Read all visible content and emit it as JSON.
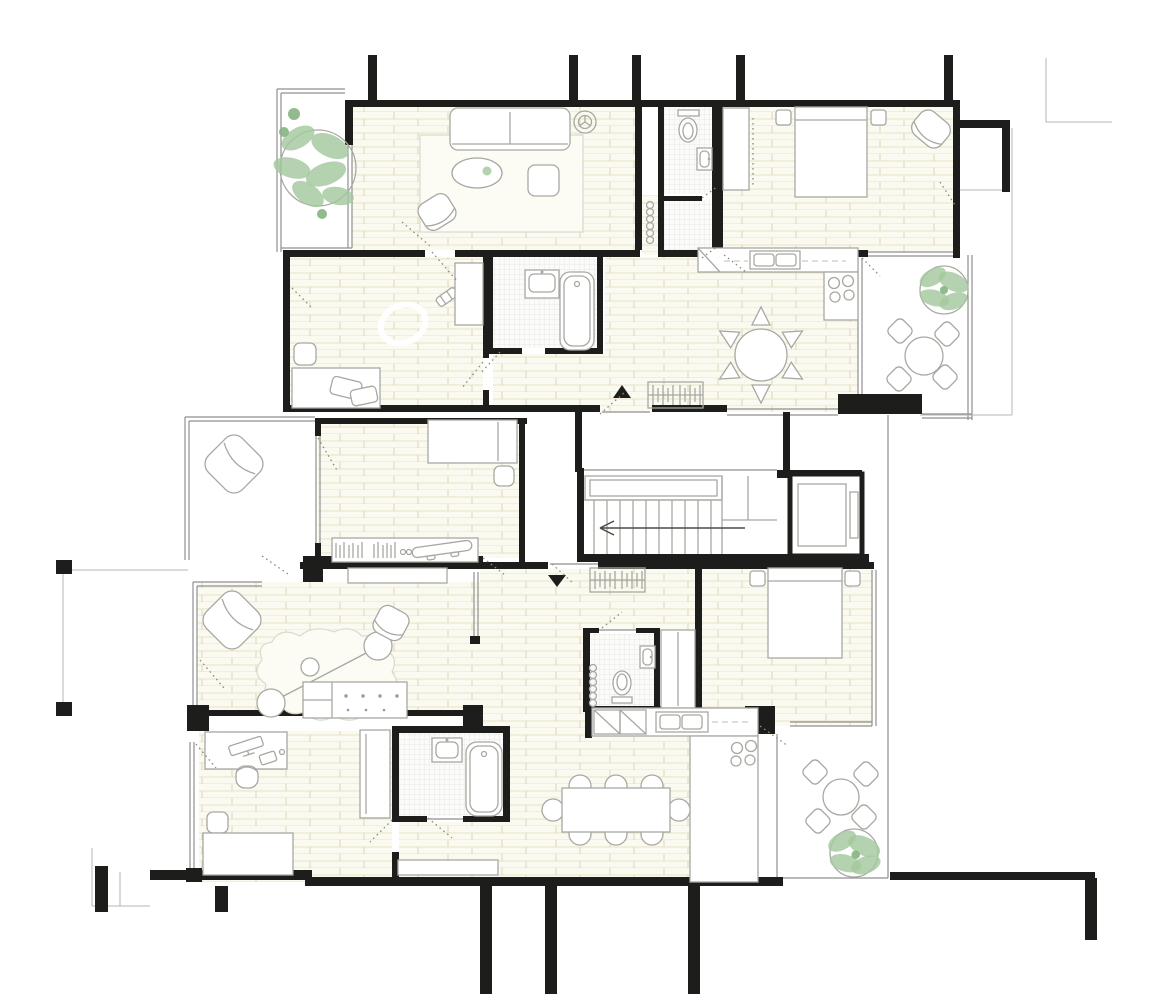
{
  "meta": {
    "drawing_type": "architectural floor plan",
    "view": "top-down furnished plan, two residential units around a stair core",
    "visible_text": []
  },
  "colors": {
    "wall": "#1d1d1b",
    "furniture_line": "#a8a8a2",
    "glass_line": "#8f8f8f",
    "floor_bg": "#fbfaf0",
    "floor_line": "#e7e2c7",
    "floor_tick": "#ded7b8",
    "tile_bg": "#fbfbf9",
    "tile_line": "#e4e4e0",
    "plant": "#a3c89e",
    "plant_dark": "#85b480",
    "door_dash": "#8d8d7b",
    "background": "#ffffff"
  },
  "core": {
    "staircase": {
      "treads": 11,
      "direction_arrow": "left",
      "landing": true
    },
    "elevator": {
      "cabin": true,
      "door_side": "right"
    }
  },
  "symbols": {
    "entry_arrow_upper": "black triangle pointing up",
    "entry_arrow_lower": "black triangle pointing down",
    "radiators": 2,
    "coat_hook_rows": [
      {
        "hooks": 6
      },
      {
        "hooks": 6
      }
    ],
    "ceiling_symbol": "circular 3-spoke symbol in living room"
  },
  "upper_unit": {
    "rooms": [
      {
        "name": "living-room",
        "furniture": [
          "sofa",
          "rug",
          "oval-coffee-table",
          "table-plant",
          "pouf",
          "armchair",
          "ceiling-symbol"
        ]
      },
      {
        "name": "wc",
        "furniture": [
          "toilet",
          "washbasin"
        ],
        "floor": "tile"
      },
      {
        "name": "shower-room",
        "furniture": [],
        "floor": "tile"
      },
      {
        "name": "bedroom",
        "furniture": [
          "double-bed",
          "nightstand",
          "nightstand",
          "wardrobe",
          "armchair"
        ]
      },
      {
        "name": "kitchen-dining",
        "furniture": [
          "counter-with-sink",
          "corner-cabinet",
          "cooktop-4-burners",
          "round-table",
          "6-chairs",
          "coat-hooks",
          "radiator"
        ]
      },
      {
        "name": "kids-room",
        "furniture": [
          "toy-racetrack",
          "toy-car",
          "desk",
          "desk-objects",
          "pouf",
          "shelf"
        ]
      },
      {
        "name": "bathroom",
        "furniture": [
          "washbasin",
          "bathtub"
        ],
        "floor": "tile"
      },
      {
        "name": "front-balcony",
        "furniture": [
          "plant"
        ]
      },
      {
        "name": "terrace",
        "furniture": [
          "round-table",
          "4-chairs",
          "plant"
        ]
      }
    ]
  },
  "middle_zone": {
    "rooms": [
      {
        "name": "bedroom-2",
        "furniture": [
          "bed",
          "pouf",
          "bookshelf",
          "books",
          "skateboard"
        ]
      },
      {
        "name": "loggia",
        "furniture": [
          "lounge-chair"
        ]
      }
    ]
  },
  "lower_unit": {
    "rooms": [
      {
        "name": "living-room",
        "furniture": [
          "lounge-chair",
          "armchair",
          "organic-rug",
          "stool",
          "stool",
          "stool",
          "kitchen-island",
          "sideboard",
          "glass-partition"
        ]
      },
      {
        "name": "entry-hall",
        "furniture": [
          "radiator",
          "coat-hooks"
        ]
      },
      {
        "name": "wc",
        "furniture": [
          "toilet",
          "washbasin"
        ],
        "floor": "tile"
      },
      {
        "name": "wardrobe-niche",
        "furniture": [
          "wardrobe"
        ]
      },
      {
        "name": "bedroom-3",
        "furniture": [
          "double-bed",
          "nightstand",
          "nightstand"
        ]
      },
      {
        "name": "kitchen-dining",
        "furniture": [
          "counter-with-sink",
          "corner-cabinets",
          "cooktop-4-burners",
          "dining-table",
          "8-chairs"
        ]
      },
      {
        "name": "bedroom-4",
        "furniture": [
          "desk",
          "computer",
          "desk-chair",
          "pouf",
          "bed",
          "wardrobe"
        ]
      },
      {
        "name": "bathroom-2",
        "furniture": [
          "washbasin",
          "bathtub"
        ],
        "floor": "tile"
      },
      {
        "name": "corridor",
        "furniture": [
          "bench"
        ]
      },
      {
        "name": "terrace",
        "furniture": [
          "round-table",
          "4-chairs",
          "plant"
        ]
      }
    ]
  }
}
